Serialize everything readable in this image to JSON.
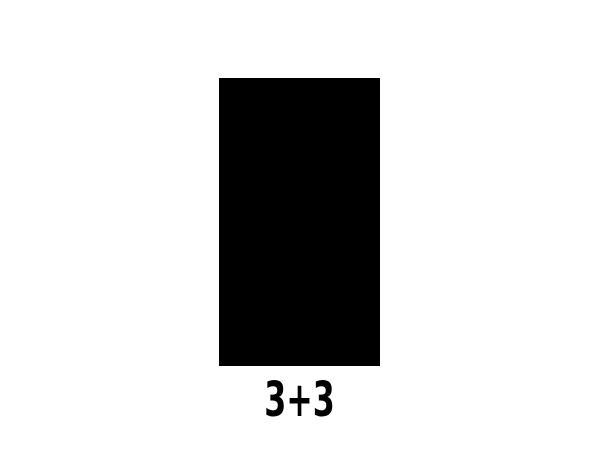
{
  "canvas": {
    "background_color": "#ffffff"
  },
  "figure": {
    "shape": "rectangle",
    "fill_color": "#000000"
  },
  "caption": {
    "text": "3+3",
    "color": "#000000"
  }
}
